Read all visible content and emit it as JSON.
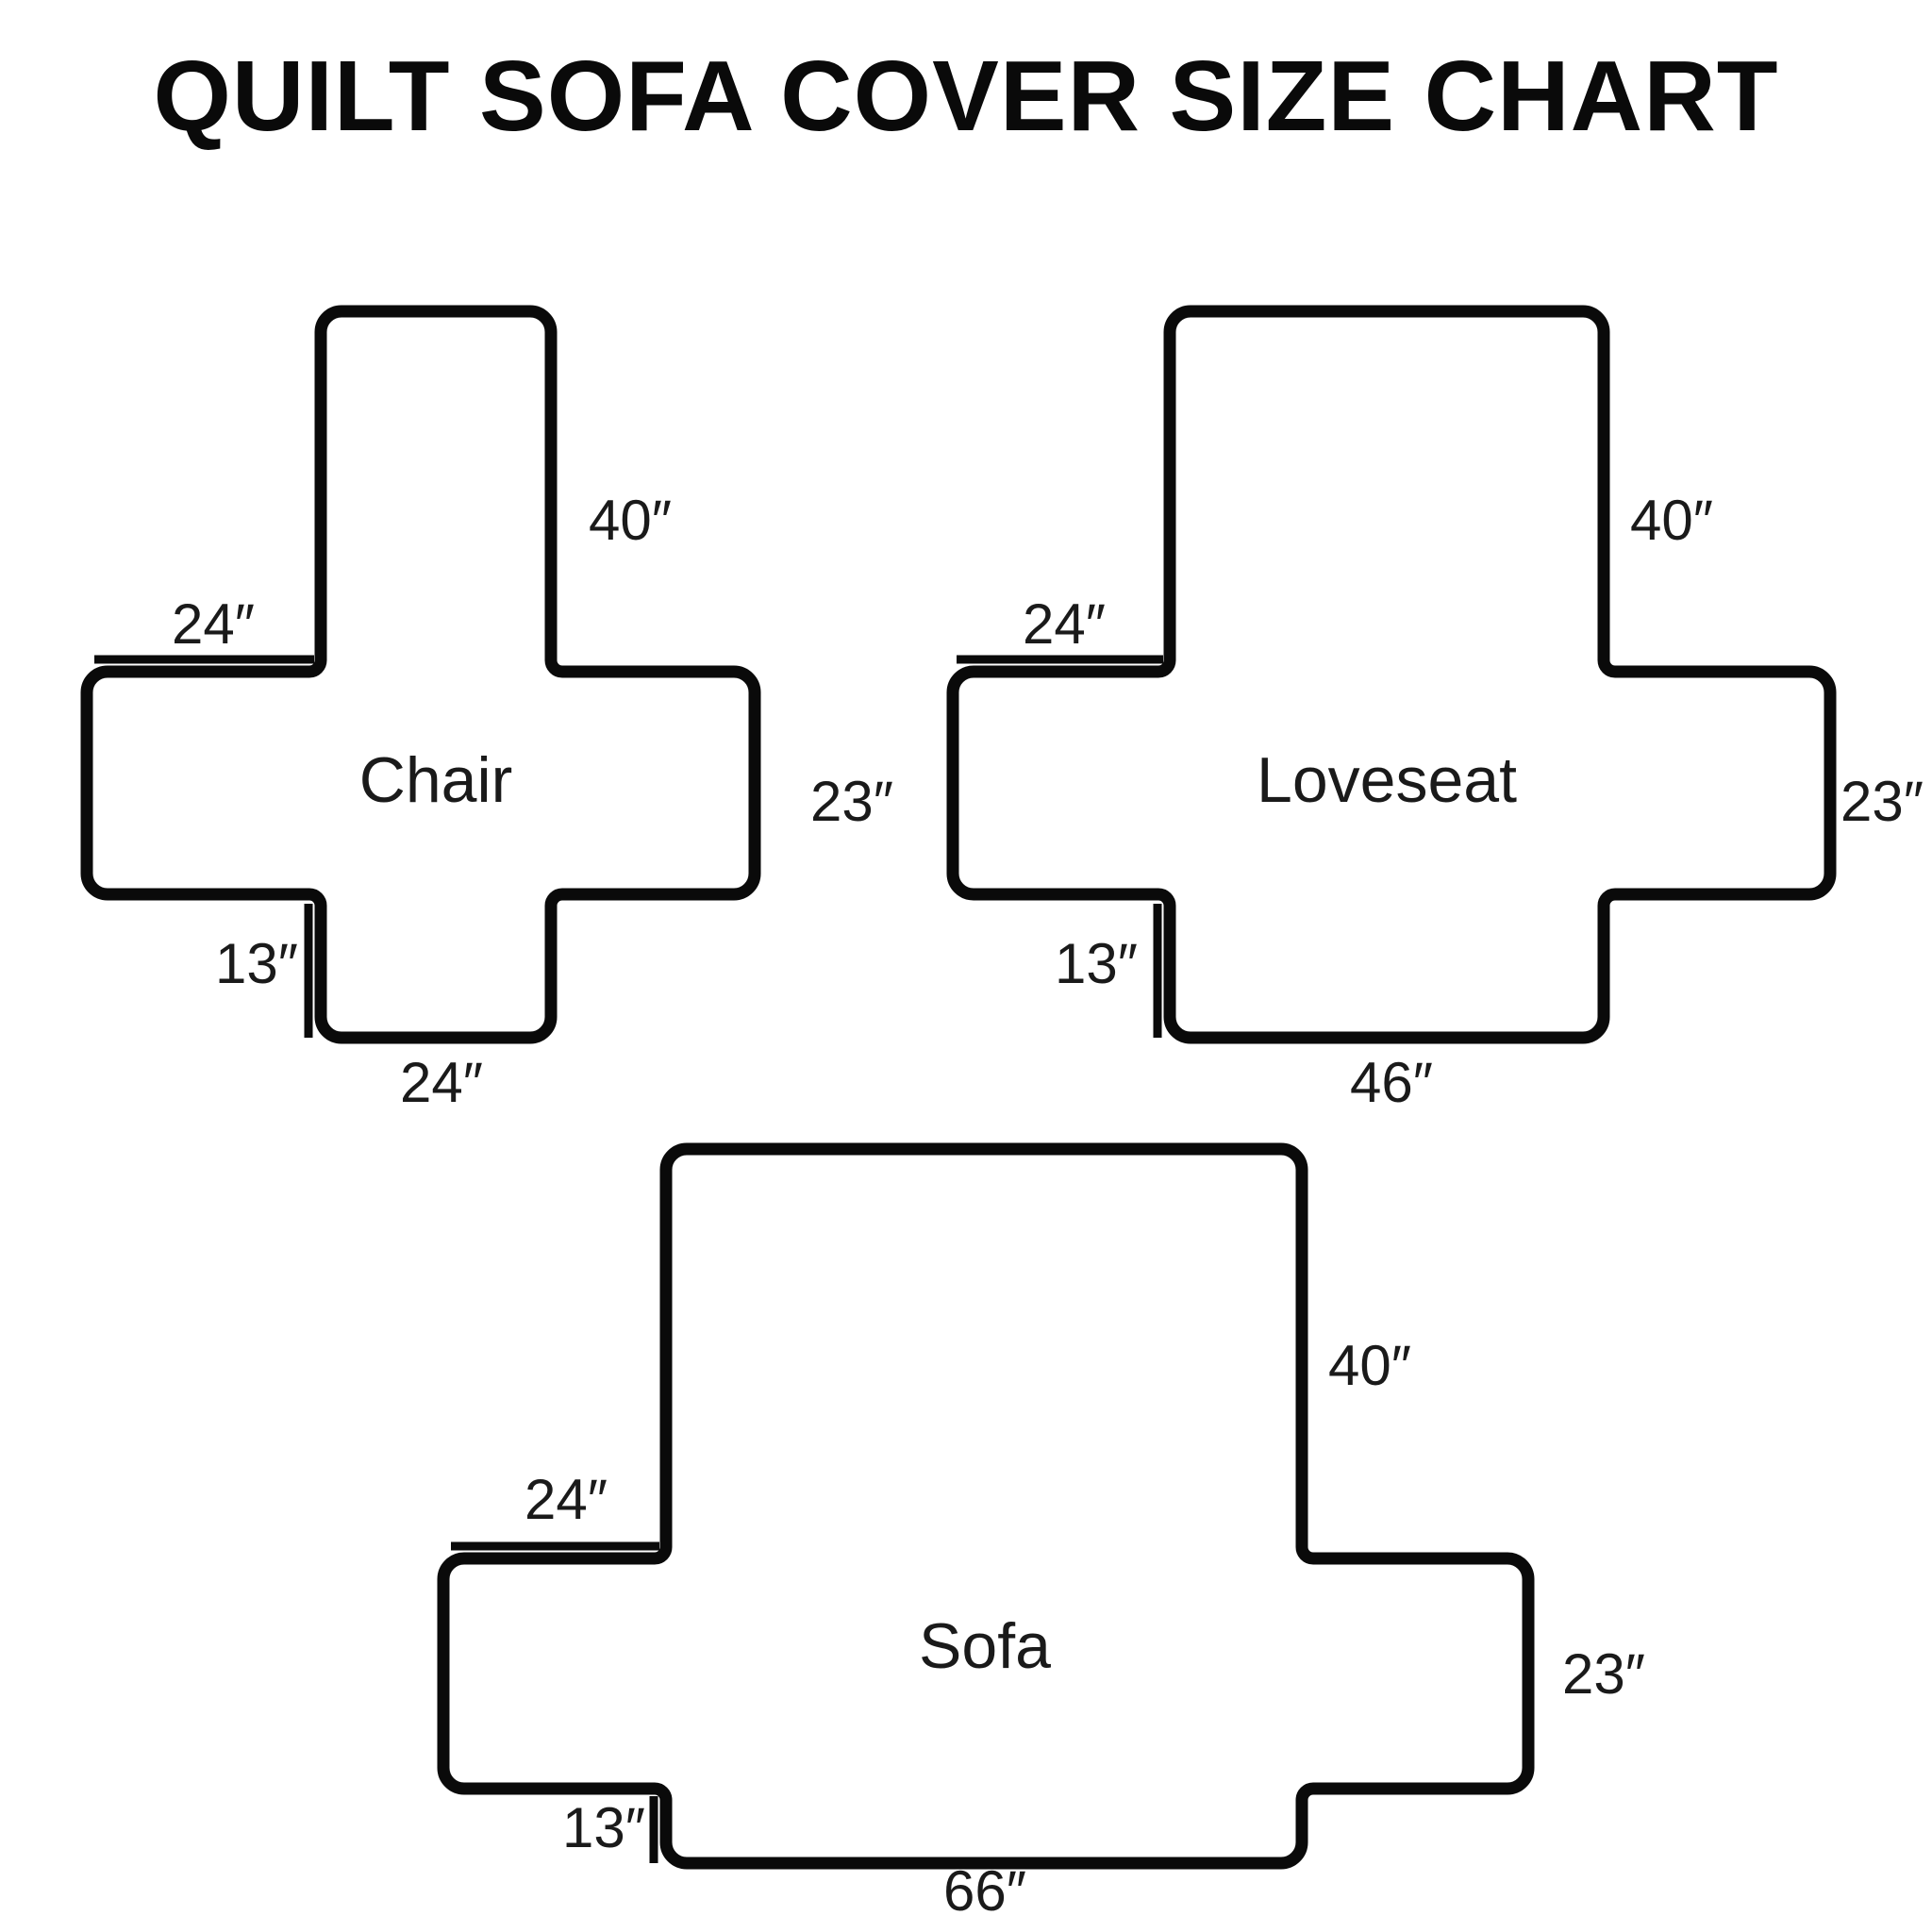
{
  "title": "QUILT SOFA COVER SIZE CHART",
  "colors": {
    "line": "#0a0a0a",
    "text": "#1a1a1a",
    "background": "#ffffff"
  },
  "diagrams": [
    {
      "name": "Chair",
      "back_height": "40″",
      "arm_top_width": "24″",
      "side_height": "23″",
      "front_drop": "13″",
      "bottom_width": "24″"
    },
    {
      "name": "Loveseat",
      "back_height": "40″",
      "arm_top_width": "24″",
      "side_height": "23″",
      "front_drop": "13″",
      "bottom_width": "46″"
    },
    {
      "name": "Sofa",
      "back_height": "40″",
      "arm_top_width": "24″",
      "side_height": "23″",
      "front_drop": "13″",
      "bottom_width": "66″"
    }
  ]
}
